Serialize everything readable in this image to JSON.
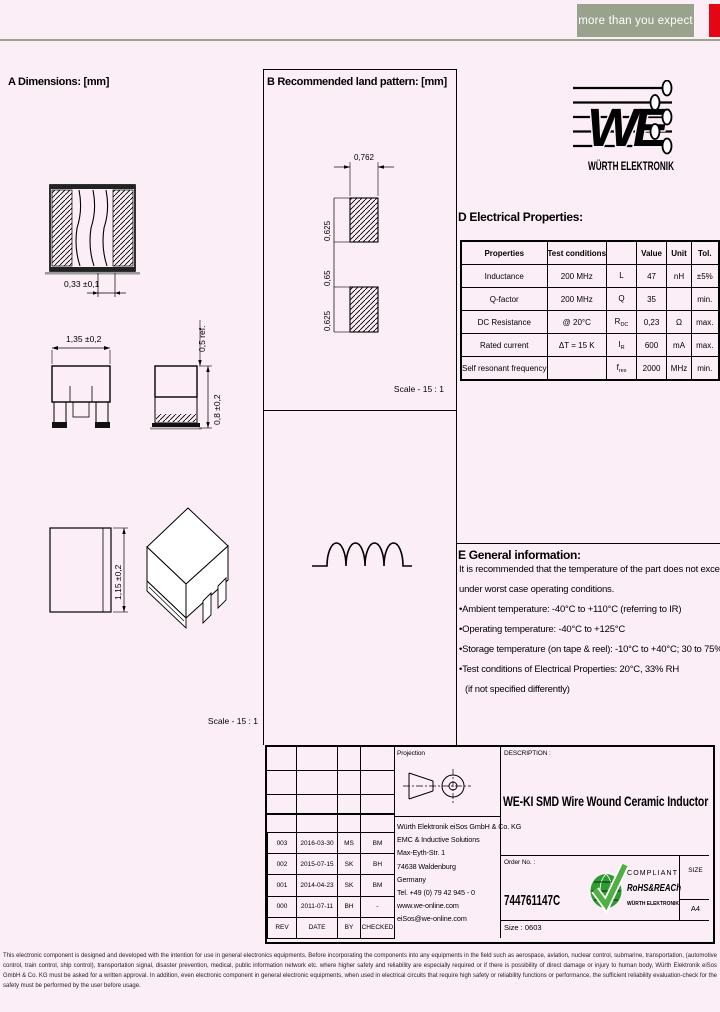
{
  "header": {
    "tagline": "more than you expect",
    "colors": {
      "we_red": "#e30613",
      "tagline_bg": "#98a28c",
      "header_rule": "#9aa48c",
      "page_bg": "#fbeef7",
      "rohs_green": "#3aaa35"
    }
  },
  "logo": {
    "letters": "WE",
    "brand": "WÜRTH ELEKTRONIK"
  },
  "section_a": {
    "title": "A Dimensions: [mm]",
    "dim_terminal": "0,33 ±0,1",
    "dim_width": "1,35 ±0,2",
    "dim_ref": "0,5 ref.",
    "dim_height": "0,8 ±0,2",
    "dim_depth": "1,15 ±0,2",
    "scale": "Scale - 15 : 1"
  },
  "section_b": {
    "title": "B Recommended land pattern: [mm]",
    "dim_pad_width": "0,762",
    "dim_pad_height_top": "0,625",
    "dim_gap": "0,65",
    "dim_pad_height_bottom": "0,625",
    "scale": "Scale - 15 : 1"
  },
  "section_d": {
    "title": "D Electrical Properties:",
    "headers": {
      "properties": "Properties",
      "test_conditions": "Test conditions",
      "symbol": "",
      "value": "Value",
      "unit": "Unit",
      "tol": "Tol."
    },
    "rows": [
      {
        "property": "Inductance",
        "condition": "200 MHz",
        "symbol": "L",
        "symbol_sub": "",
        "value": "47",
        "unit": "nH",
        "tol": "±5%"
      },
      {
        "property": "Q-factor",
        "condition": "200 MHz",
        "symbol": "Q",
        "symbol_sub": "",
        "value": "35",
        "unit": "",
        "tol": "min."
      },
      {
        "property": "DC Resistance",
        "condition": "@ 20°C",
        "symbol": "R",
        "symbol_sub": "DC",
        "value": "0,23",
        "unit": "Ω",
        "tol": "max."
      },
      {
        "property": "Rated current",
        "condition": "ΔT = 15 K",
        "symbol": "I",
        "symbol_sub": "R",
        "value": "600",
        "unit": "mA",
        "tol": "max."
      },
      {
        "property": "Self resonant frequency",
        "condition": "",
        "symbol": "f",
        "symbol_sub": "res",
        "value": "2000",
        "unit": "MHz",
        "tol": "min."
      }
    ]
  },
  "section_e": {
    "title": "E General information:",
    "intro_line1": "It is recommended that the temperature of the part does not exceed 125°C",
    "intro_line2": "under worst case operating conditions.",
    "bullet1": "•Ambient temperature: -40°C to +110°C (referring to IR)",
    "bullet2": "•Operating temperature: -40°C to +125°C",
    "bullet3": "•Storage temperature (on tape & reel): -10°C to +40°C; 30 to 75% RH max.",
    "bullet4": "•Test conditions of Electrical Properties: 20°C, 33% RH",
    "note": "(if not specified differently)"
  },
  "title_block": {
    "projection_label": "Projection",
    "revision_table": {
      "headers": {
        "rev": "REV",
        "date": "DATE",
        "by": "BY",
        "checked": "CHECKED"
      },
      "rows": [
        {
          "rev": "003",
          "date": "2016-03-30",
          "by": "MS",
          "checked": "BM"
        },
        {
          "rev": "002",
          "date": "2015-07-15",
          "by": "SK",
          "checked": "BH"
        },
        {
          "rev": "001",
          "date": "2014-04-23",
          "by": "SK",
          "checked": "BM"
        },
        {
          "rev": "000",
          "date": "2011-07-11",
          "by": "BH",
          "checked": "-"
        }
      ]
    },
    "address": {
      "line1": "Würth Elektronik eiSos GmbH & Co. KG",
      "line2": "EMC & Inductive Solutions",
      "line3": "Max-Eyth-Str. 1",
      "line4": "74638 Waldenburg",
      "line5": "Germany",
      "line6": "Tel. +49 (0) 79 42 945 - 0",
      "line7": "www.we-online.com",
      "line8": "eiSos@we-online.com"
    },
    "description_label": "DESCRIPTION :",
    "description": "WE-KI SMD Wire Wound Ceramic Inductor",
    "order_label": "Order No. :",
    "order_number": "744761147C",
    "rohs_badge": {
      "compliant": "COMPLIANT",
      "name": "RoHS&REACh",
      "brand": "WÜRTH ELEKTRONIK"
    },
    "size_box_label": "SIZE",
    "size_box_value": "A4",
    "size_line_label": "Size :",
    "size_line_value": "0603"
  },
  "disclaimer": "This electronic component is designed and developed with the intention for use in general electronics equipments. Before incorporating the components into any equipments in the field such as aerospace, aviation, nuclear control, submarine, transportation, (automotive control, train control, ship control), transportation signal, disaster prevention, medical, public information network etc. where higher safety and reliability are especially required or if there is possibility of direct damage or injury to human body, Würth Elektronik eiSos GmbH & Co. KG must be asked for a written approval. In addition, even electronic component in general electronic equipments, when used in electrical circuits that require high safety or reliability functions or performance, the sufficient reliability evaluation-check for the safety must be performed by the user before usage."
}
